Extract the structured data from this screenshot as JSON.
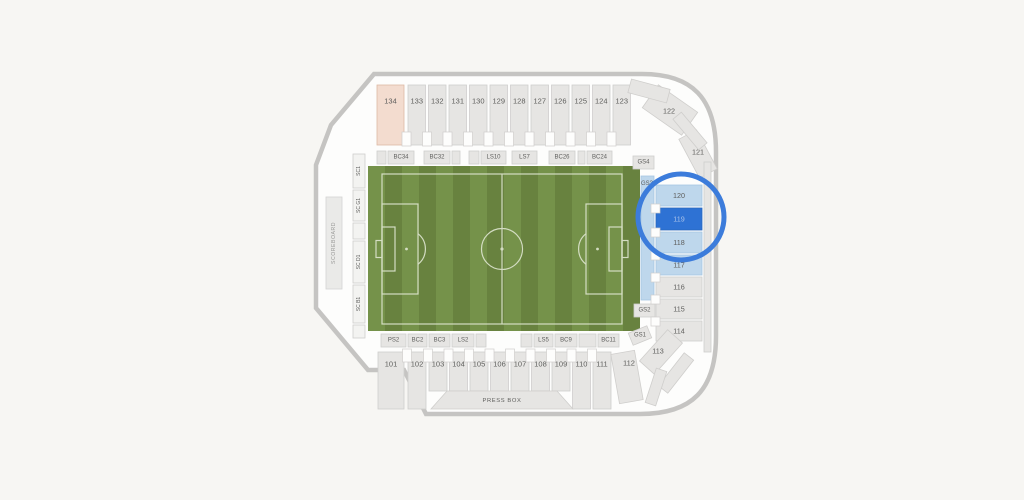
{
  "page": {
    "background": "#f7f6f3"
  },
  "stadium": {
    "colors": {
      "interior": "#fdfdfc",
      "wall": "#c5c4c2",
      "section_fill": "#e6e5e3",
      "section_stroke": "#cfcecc",
      "label_text": "#5e5e5c",
      "pink_fill": "#f3dccf",
      "pink_stroke": "#ddb8a4",
      "lightblue_fill": "#bed7ec",
      "lightblue_stroke": "#a5c6e2",
      "selected_fill": "#2e72d4",
      "selected_stroke": "#2767bd",
      "selected_text": "#a8c1e9",
      "sc_fill": "#f3f3f1",
      "ring": "#3c7cdb",
      "field_light": "#75924a",
      "field_dark": "#68823f",
      "field_line": "#dfe6d1",
      "scoreboard_fill": "#eaeae8",
      "scoreboard_stroke": "#d4d4d2",
      "scoreboard_text": "#9a9a98"
    },
    "outline_path": "M 374 74 H 642 C 692 74 716 98 716 152 V 336 C 716 390 692 414 640 414 H 426 L 404 370 H 368 L 316 308 V 165 L 331 125 Z",
    "ring": {
      "cx": 681,
      "cy": 217,
      "r": 43,
      "stroke_width": 5
    },
    "field": {
      "x": 368,
      "y": 166,
      "w": 272,
      "h": 165,
      "stripe_w": 17,
      "pitch": {
        "x": 382,
        "y": 174,
        "w": 240,
        "h": 150
      }
    },
    "scoreboard": {
      "label": "SCOREBOARD",
      "x": 326,
      "y": 197,
      "w": 16,
      "h": 92,
      "fs": 5.2
    },
    "press_box": {
      "label": "PRESS BOX",
      "points": "447,391 557,391 573,409 431,409",
      "lx": 502,
      "ly": 401,
      "fs": 5.8
    },
    "selected_section": "119",
    "sections": [
      {
        "label": "134",
        "x": 377,
        "y": 85,
        "w": 27,
        "h": 60,
        "type": "pink",
        "ly": 101
      },
      {
        "label": "133",
        "x": 408,
        "y": 85,
        "w": 17.5,
        "h": 60,
        "ly": 101
      },
      {
        "label": "132",
        "x": 428.5,
        "y": 85,
        "w": 17.5,
        "h": 60,
        "ly": 101
      },
      {
        "label": "131",
        "x": 449,
        "y": 85,
        "w": 17.5,
        "h": 60,
        "ly": 101
      },
      {
        "label": "130",
        "x": 469.5,
        "y": 85,
        "w": 17.5,
        "h": 60,
        "ly": 101
      },
      {
        "label": "129",
        "x": 490,
        "y": 85,
        "w": 17.5,
        "h": 60,
        "ly": 101
      },
      {
        "label": "128",
        "x": 510.5,
        "y": 85,
        "w": 17.5,
        "h": 60,
        "ly": 101
      },
      {
        "label": "127",
        "x": 531,
        "y": 85,
        "w": 17.5,
        "h": 60,
        "ly": 101
      },
      {
        "label": "126",
        "x": 551.5,
        "y": 85,
        "w": 17.5,
        "h": 60,
        "ly": 101
      },
      {
        "label": "125",
        "x": 572,
        "y": 85,
        "w": 17.5,
        "h": 60,
        "ly": 101
      },
      {
        "label": "124",
        "x": 592.5,
        "y": 85,
        "w": 17.5,
        "h": 60,
        "ly": 101
      },
      {
        "label": "123",
        "x": 613,
        "y": 85,
        "w": 17.5,
        "h": 60,
        "ly": 101
      },
      {
        "label": "122",
        "x": 646,
        "y": 96,
        "w": 48,
        "h": 28,
        "rot": 35,
        "lx": 669,
        "ly": 111,
        "fs": 7.2
      },
      {
        "label": "121",
        "x": 676,
        "y": 144,
        "w": 44,
        "h": 20,
        "rot": 62,
        "lx": 698,
        "ly": 152,
        "fs": 7.2
      },
      {
        "label": "",
        "x": 629,
        "y": 84,
        "w": 40,
        "h": 14,
        "rot": 15
      },
      {
        "label": "",
        "x": 670,
        "y": 125.5,
        "w": 40,
        "h": 11,
        "rot": 50
      },
      {
        "label": "",
        "x": 704,
        "y": 162,
        "w": 7,
        "h": 190
      },
      {
        "label": "",
        "x": 377,
        "y": 151,
        "w": 9,
        "h": 13
      },
      {
        "label": "BC34",
        "x": 388,
        "y": 151,
        "w": 26,
        "h": 13,
        "fs": 6
      },
      {
        "label": "BC32",
        "x": 424,
        "y": 151,
        "w": 26,
        "h": 13,
        "fs": 6
      },
      {
        "label": "",
        "x": 452,
        "y": 151,
        "w": 8,
        "h": 13
      },
      {
        "label": "",
        "x": 469,
        "y": 151,
        "w": 10,
        "h": 13
      },
      {
        "label": "LS10",
        "x": 481,
        "y": 151,
        "w": 25,
        "h": 13,
        "fs": 6
      },
      {
        "label": "LS7",
        "x": 512,
        "y": 151,
        "w": 25,
        "h": 13,
        "fs": 6
      },
      {
        "label": "BC26",
        "x": 549,
        "y": 151,
        "w": 26,
        "h": 13,
        "fs": 6
      },
      {
        "label": "",
        "x": 578,
        "y": 151,
        "w": 7,
        "h": 13
      },
      {
        "label": "BC24",
        "x": 587,
        "y": 151,
        "w": 25,
        "h": 13,
        "fs": 6
      },
      {
        "label": "GS4",
        "x": 633,
        "y": 156,
        "w": 21,
        "h": 13,
        "fs": 6
      },
      {
        "label": "GS3",
        "x": 641,
        "y": 176,
        "w": 13,
        "h": 124,
        "type": "lightblue",
        "fs": 6,
        "lx": 647,
        "ly": 184
      },
      {
        "label": "GS2",
        "x": 634,
        "y": 304,
        "w": 21,
        "h": 13,
        "fs": 6
      },
      {
        "label": "GS1",
        "x": 630,
        "y": 329,
        "w": 20,
        "h": 13,
        "fs": 6,
        "rot": -22
      },
      {
        "label": "120",
        "x": 656,
        "y": 185,
        "w": 46,
        "h": 21,
        "type": "lightblue",
        "fs": 7.2
      },
      {
        "label": "119",
        "x": 656,
        "y": 208,
        "w": 46,
        "h": 22,
        "type": "selected",
        "fs": 7.2
      },
      {
        "label": "118",
        "x": 656,
        "y": 232,
        "w": 46,
        "h": 21,
        "type": "lightblue",
        "fs": 7.2
      },
      {
        "label": "117",
        "x": 656,
        "y": 255,
        "w": 46,
        "h": 20,
        "type": "lightblue",
        "fs": 7.2
      },
      {
        "label": "116",
        "x": 656,
        "y": 277,
        "w": 46,
        "h": 20,
        "fs": 7.2
      },
      {
        "label": "115",
        "x": 656,
        "y": 299,
        "w": 46,
        "h": 20,
        "fs": 7.2
      },
      {
        "label": "114",
        "x": 656,
        "y": 321,
        "w": 46,
        "h": 20,
        "fs": 7.2
      },
      {
        "label": "113",
        "x": 640,
        "y": 342,
        "w": 42,
        "h": 20,
        "rot": -48,
        "lx": 658,
        "ly": 351,
        "fs": 7.2
      },
      {
        "label": "",
        "x": 655,
        "y": 367,
        "w": 42,
        "h": 12,
        "rot": -52
      },
      {
        "label": "",
        "x": 638,
        "y": 381.5,
        "w": 36,
        "h": 11,
        "rot": -72
      },
      {
        "label": "SC1",
        "x": 353,
        "y": 154,
        "w": 12,
        "h": 34,
        "type": "sc",
        "fs": 5,
        "vertical": true
      },
      {
        "label": "SC G1",
        "x": 353,
        "y": 190,
        "w": 12,
        "h": 31,
        "type": "sc",
        "fs": 5,
        "vertical": true
      },
      {
        "label": "",
        "x": 353,
        "y": 223,
        "w": 12,
        "h": 16,
        "type": "sc"
      },
      {
        "label": "SC D1",
        "x": 353,
        "y": 241,
        "w": 12,
        "h": 42,
        "type": "sc",
        "fs": 5,
        "vertical": true
      },
      {
        "label": "SC B1",
        "x": 353,
        "y": 285,
        "w": 12,
        "h": 38,
        "type": "sc",
        "fs": 5,
        "vertical": true
      },
      {
        "label": "",
        "x": 353,
        "y": 325,
        "w": 12,
        "h": 13,
        "type": "sc"
      },
      {
        "label": "PS2",
        "x": 381,
        "y": 334,
        "w": 25,
        "h": 13,
        "fs": 6
      },
      {
        "label": "BC2",
        "x": 408,
        "y": 334,
        "w": 19,
        "h": 13,
        "fs": 6
      },
      {
        "label": "BC3",
        "x": 429,
        "y": 334,
        "w": 21,
        "h": 13,
        "fs": 6
      },
      {
        "label": "LS2",
        "x": 452,
        "y": 334,
        "w": 22,
        "h": 13,
        "fs": 6
      },
      {
        "label": "",
        "x": 476,
        "y": 334,
        "w": 10,
        "h": 13
      },
      {
        "label": "",
        "x": 521,
        "y": 334,
        "w": 11,
        "h": 13
      },
      {
        "label": "LS5",
        "x": 534,
        "y": 334,
        "w": 19,
        "h": 13,
        "fs": 6
      },
      {
        "label": "BC9",
        "x": 555,
        "y": 334,
        "w": 22,
        "h": 13,
        "fs": 6
      },
      {
        "label": "",
        "x": 579,
        "y": 334,
        "w": 17,
        "h": 13
      },
      {
        "label": "BC11",
        "x": 598,
        "y": 334,
        "w": 21,
        "h": 13,
        "fs": 6
      },
      {
        "label": "101",
        "x": 378,
        "y": 352,
        "w": 26,
        "h": 57,
        "ly": 364
      },
      {
        "label": "102",
        "x": 408,
        "y": 352,
        "w": 18,
        "h": 57,
        "ly": 364
      },
      {
        "label": "103",
        "x": 429,
        "y": 352,
        "w": 18,
        "h": 39,
        "ly": 364
      },
      {
        "label": "104",
        "x": 449.5,
        "y": 352,
        "w": 18,
        "h": 39,
        "ly": 364
      },
      {
        "label": "105",
        "x": 470,
        "y": 352,
        "w": 18,
        "h": 39,
        "ly": 364
      },
      {
        "label": "106",
        "x": 490.5,
        "y": 352,
        "w": 18,
        "h": 39,
        "ly": 364
      },
      {
        "label": "107",
        "x": 511,
        "y": 352,
        "w": 18,
        "h": 39,
        "ly": 364
      },
      {
        "label": "108",
        "x": 531.5,
        "y": 352,
        "w": 18,
        "h": 39,
        "ly": 364
      },
      {
        "label": "109",
        "x": 552,
        "y": 352,
        "w": 18,
        "h": 39,
        "ly": 364
      },
      {
        "label": "110",
        "x": 572.5,
        "y": 352,
        "w": 18,
        "h": 57,
        "ly": 364
      },
      {
        "label": "111",
        "x": 593,
        "y": 352,
        "w": 18,
        "h": 57,
        "ly": 364
      },
      {
        "label": "112",
        "x": 615,
        "y": 352,
        "w": 24,
        "h": 50,
        "rot": -10,
        "lx": 629,
        "ly": 363
      }
    ],
    "aisle_notches": [
      {
        "x": 402,
        "y": 132,
        "w": 9,
        "h": 14
      },
      {
        "x": 422.5,
        "y": 132,
        "w": 9,
        "h": 14
      },
      {
        "x": 443,
        "y": 132,
        "w": 9,
        "h": 14
      },
      {
        "x": 463.5,
        "y": 132,
        "w": 9,
        "h": 14
      },
      {
        "x": 484,
        "y": 132,
        "w": 9,
        "h": 14
      },
      {
        "x": 504.5,
        "y": 132,
        "w": 9,
        "h": 14
      },
      {
        "x": 525,
        "y": 132,
        "w": 9,
        "h": 14
      },
      {
        "x": 545.5,
        "y": 132,
        "w": 9,
        "h": 14
      },
      {
        "x": 566,
        "y": 132,
        "w": 9,
        "h": 14
      },
      {
        "x": 586.5,
        "y": 132,
        "w": 9,
        "h": 14
      },
      {
        "x": 607,
        "y": 132,
        "w": 9,
        "h": 14
      },
      {
        "x": 402.5,
        "y": 349,
        "w": 9,
        "h": 13
      },
      {
        "x": 423.5,
        "y": 349,
        "w": 9,
        "h": 13
      },
      {
        "x": 444,
        "y": 349,
        "w": 9,
        "h": 13
      },
      {
        "x": 464.5,
        "y": 349,
        "w": 9,
        "h": 13
      },
      {
        "x": 485,
        "y": 349,
        "w": 9,
        "h": 13
      },
      {
        "x": 505.5,
        "y": 349,
        "w": 9,
        "h": 13
      },
      {
        "x": 526,
        "y": 349,
        "w": 9,
        "h": 13
      },
      {
        "x": 546.5,
        "y": 349,
        "w": 9,
        "h": 13
      },
      {
        "x": 567,
        "y": 349,
        "w": 9,
        "h": 13
      },
      {
        "x": 587.5,
        "y": 349,
        "w": 9,
        "h": 13
      },
      {
        "x": 651,
        "y": 204,
        "w": 9,
        "h": 9
      },
      {
        "x": 651,
        "y": 228,
        "w": 9,
        "h": 9
      },
      {
        "x": 651,
        "y": 251,
        "w": 9,
        "h": 9
      },
      {
        "x": 651,
        "y": 273,
        "w": 9,
        "h": 9
      },
      {
        "x": 651,
        "y": 295,
        "w": 9,
        "h": 9
      },
      {
        "x": 651,
        "y": 317,
        "w": 9,
        "h": 9
      }
    ]
  }
}
